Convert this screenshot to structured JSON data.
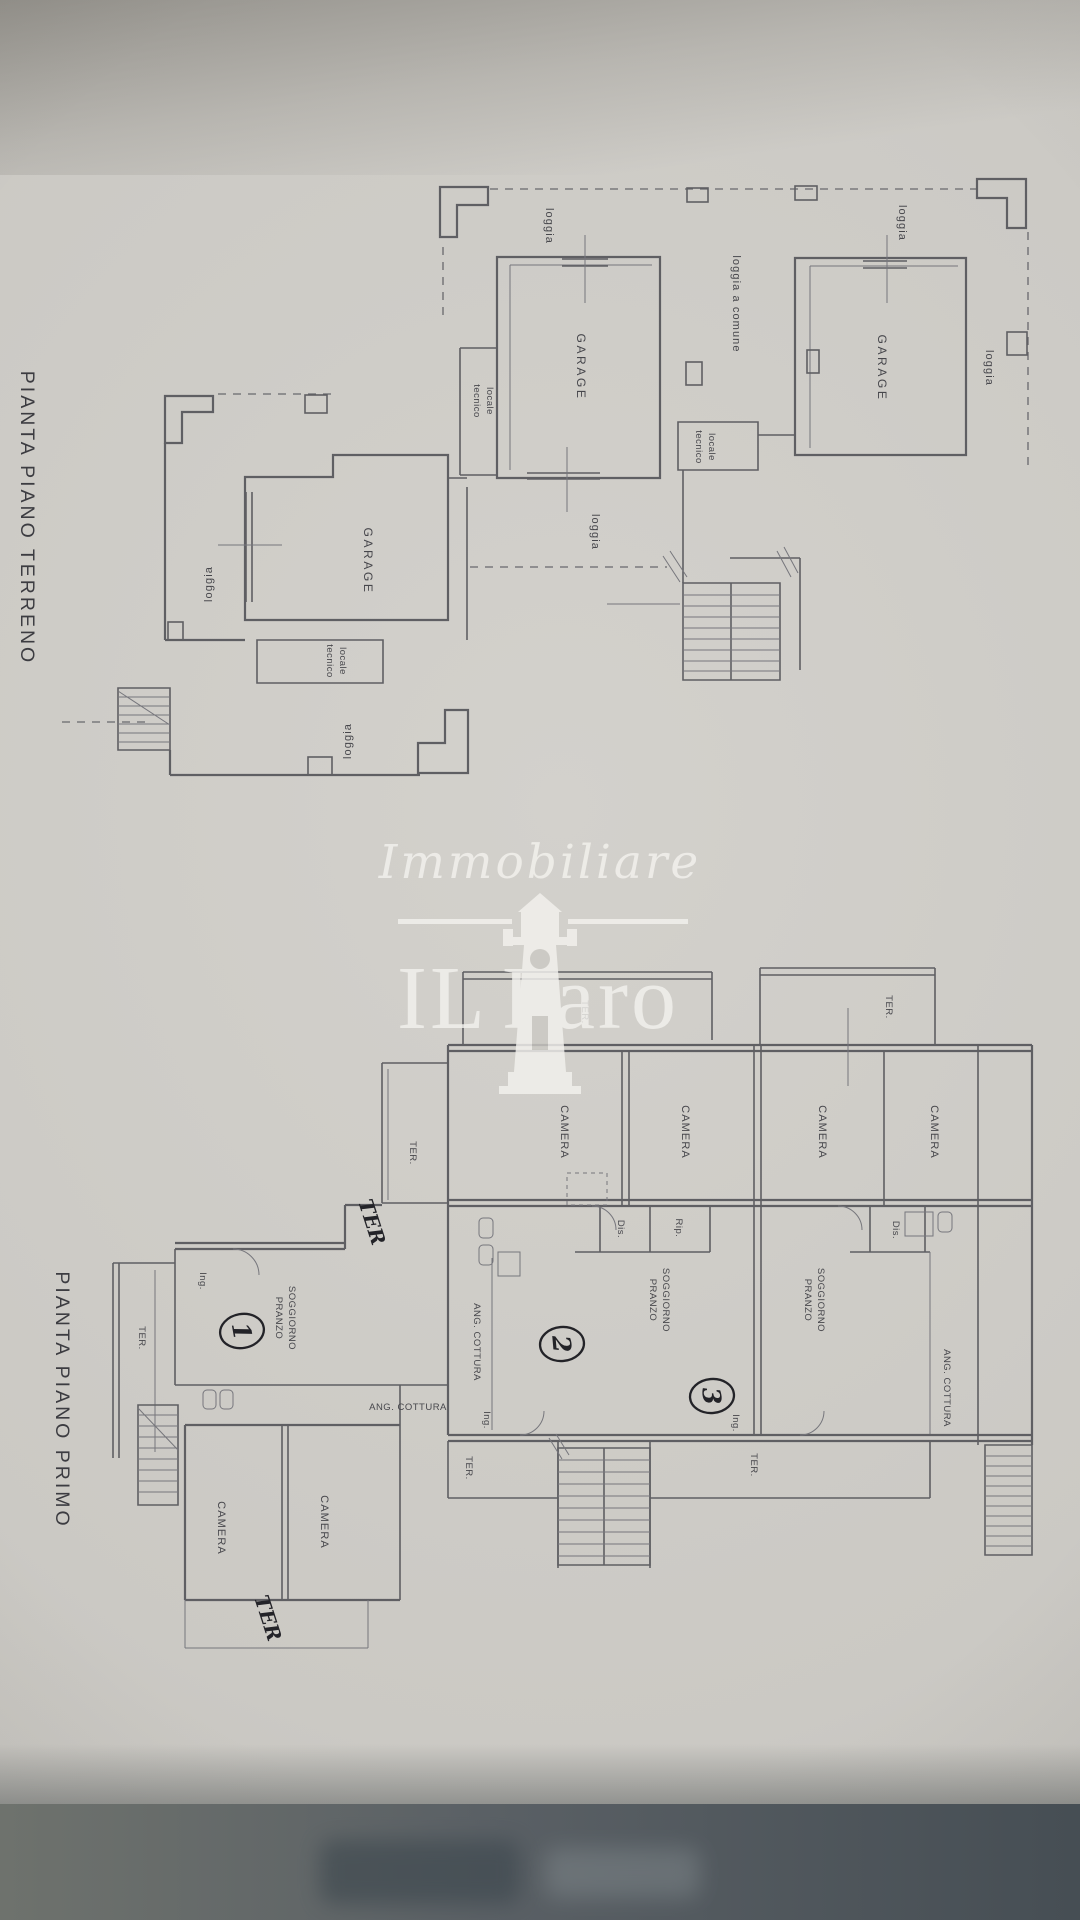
{
  "photo": {
    "paper_color": "#cbc9c4",
    "background_color": "#8b8985",
    "bottom_band_color": "#555c5e",
    "line_color": "#5f5f63",
    "label_color": "#47474c",
    "handwriting_color": "#232328",
    "watermark_color": "#f3f2ee"
  },
  "ground_floor": {
    "title": "PIANTA PIANO TERRENO",
    "labels": {
      "garage": "GARAGE",
      "loggia": "loggia",
      "loggia_comune": "loggia a comune",
      "locale": "locale",
      "tecnico": "tecnico"
    }
  },
  "first_floor": {
    "title": "PIANTA PIANO PRIMO",
    "labels": {
      "camera": "CAMERA",
      "ter": "TER.",
      "soggiorno": "SOGGIORNO",
      "pranzo": "PRANZO",
      "ang_cottura": "ANG. COTTURA",
      "dis": "Dis.",
      "rip": "Rip.",
      "ing": "Ing."
    },
    "handwritten": {
      "ter": "TER",
      "unit_1": "1",
      "unit_2": "2",
      "unit_3": "3"
    }
  },
  "watermark": {
    "agency_script": "Immobiliare",
    "agency_name_il": "IL",
    "agency_name_faro": "Faro"
  }
}
